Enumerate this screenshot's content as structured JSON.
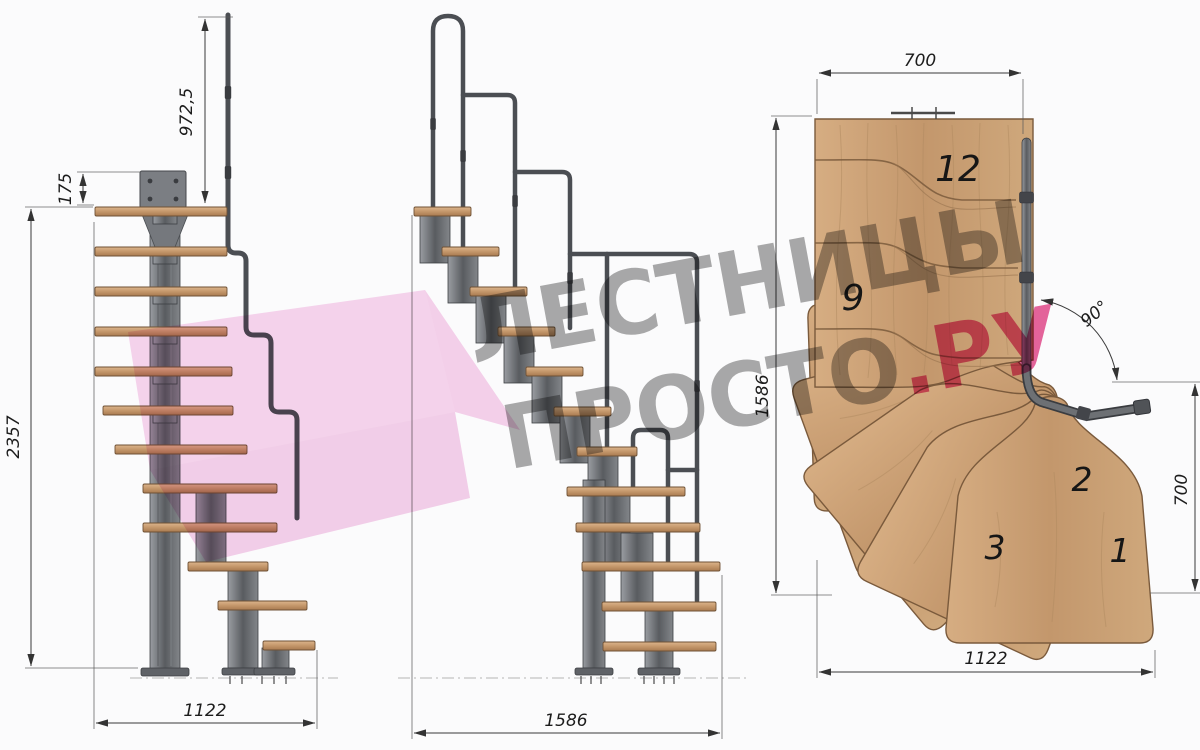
{
  "palette": {
    "background": "#fbfbfc",
    "wood": "#c79a6e",
    "wood_outline": "#7a5a3c",
    "steel": "#5a5d61",
    "steel_dark": "#3c3e41",
    "dimension_line": "#3a3a3a",
    "watermark_grey": "#9a9a9a",
    "watermark_pink": "#e2307d",
    "arrow_pink": "#f1aedd"
  },
  "watermark": {
    "line1": "ЛЕСТНИЦЫ",
    "line2_main": "ПРОСТО",
    "line2_accent": ".РУ"
  },
  "side_view": {
    "dims": {
      "handrail_height": "972,5",
      "top_offset": "175",
      "total_height": "2357",
      "footprint": "1122"
    }
  },
  "front_view": {
    "dims": {
      "footprint": "1586"
    }
  },
  "plan_view": {
    "dims": {
      "upper_flight_width": "700",
      "depth": "1586",
      "lower_flight_width": "700",
      "width": "1122",
      "turn_angle": "90°"
    },
    "steps": {
      "s12": "12",
      "s9": "9",
      "s3": "3",
      "s2": "2",
      "s1": "1"
    }
  }
}
